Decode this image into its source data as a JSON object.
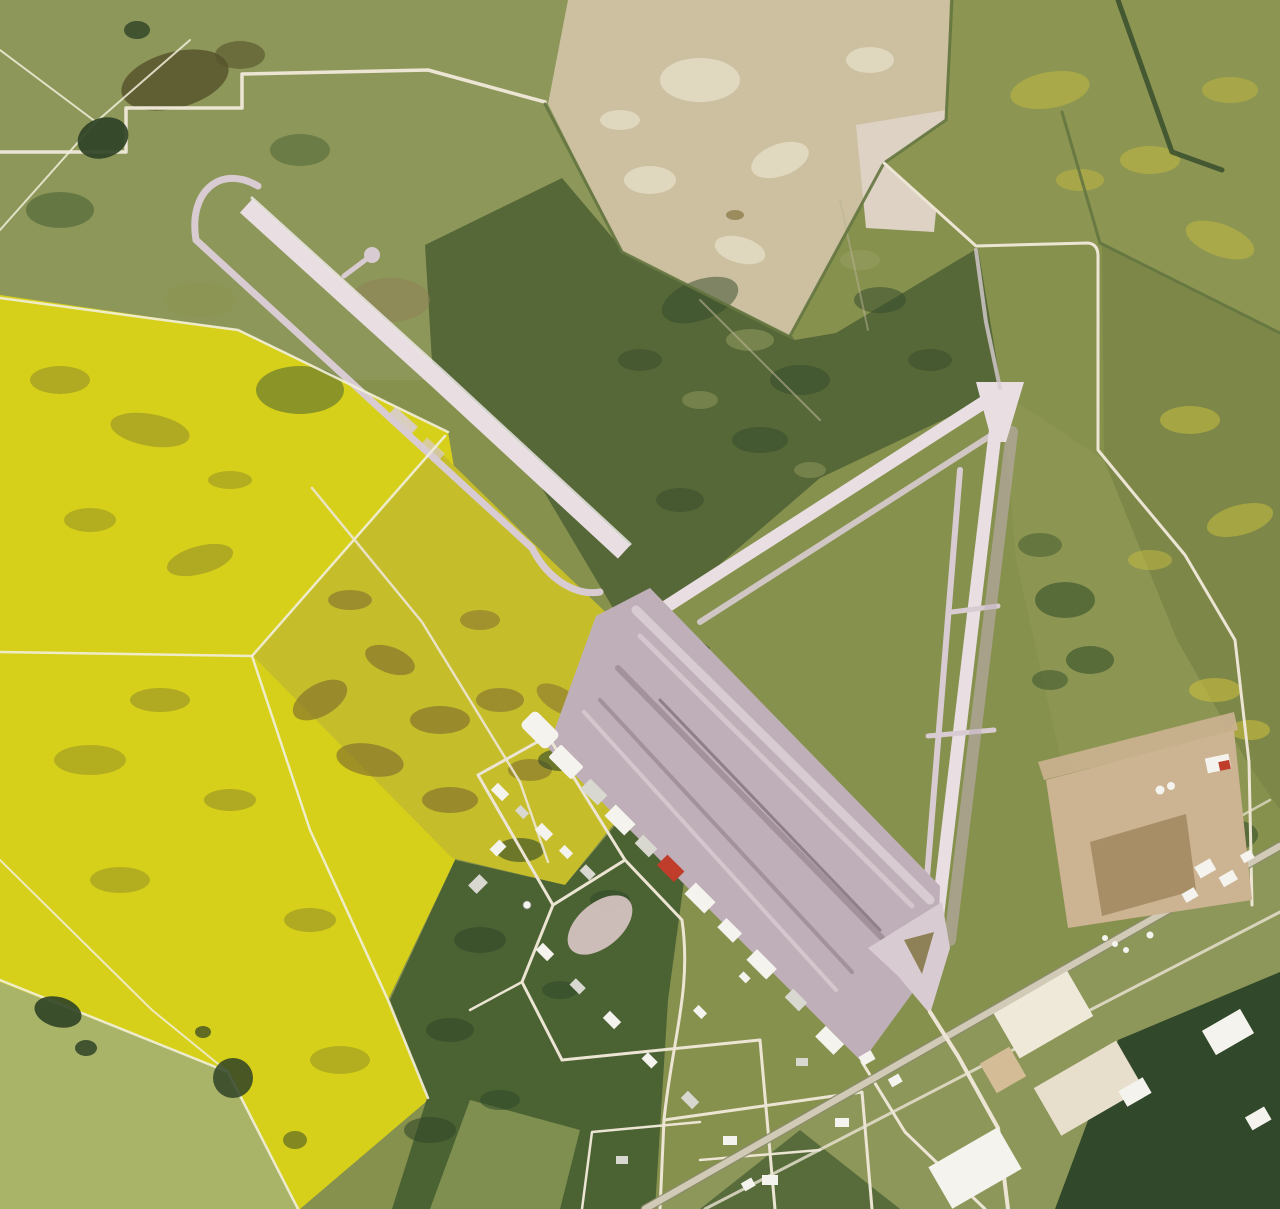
{
  "scene": {
    "description": "Aerial satellite photograph of an abandoned triangular airfield surrounded by farmland: a long NW-SE main runway with a loop taxiway, a runway triangle converging at north and south vertices, a worn apron with a hangar line and service-road grid, bright yellow canola fields to the west, tan fallow fields to the north, a dark shelterbelt forest strip, a gravel pad, and a diagonal highway with white industrial buildings in the southeast corner.",
    "features": [
      {
        "name": "main-runway",
        "label": "Main runway NW-SE"
      },
      {
        "name": "crosswind-runway-ne",
        "label": "Crosswind runway from north vertex to main runway"
      },
      {
        "name": "north-south-runway",
        "label": "North-south runway of triangle"
      },
      {
        "name": "loop-taxiway",
        "label": "Loop taxiway around northwest runway end"
      },
      {
        "name": "apron",
        "label": "Worn apron with parallel taxi lanes"
      },
      {
        "name": "hangar-row",
        "label": "Row of hangars along apron edge"
      },
      {
        "name": "red-roof-building",
        "label": "Small red-roofed building in hangar row"
      },
      {
        "name": "base-township",
        "label": "Service building grid southwest of apron"
      },
      {
        "name": "canola-fields",
        "label": "Bright yellow canola fields"
      },
      {
        "name": "tan-fields",
        "label": "Tan fallow fields to the north"
      },
      {
        "name": "forest-strip",
        "label": "Dark shelterbelt forest strip"
      },
      {
        "name": "gravel-pad",
        "label": "Large tan gravel pad east of south vertex"
      },
      {
        "name": "highway",
        "label": "Diagonal highway across southeast corner"
      },
      {
        "name": "industrial-buildings",
        "label": "White industrial warehouses along highway"
      },
      {
        "name": "ponds",
        "label": "Small dark ponds and tree clumps"
      }
    ]
  },
  "palette": {
    "base": "#87914e",
    "sage": "#8d975a",
    "palegrass": "#a9b468",
    "canola": "#d7d01a",
    "canola2": "#c6bd2a",
    "canolashadow": "#878427",
    "dirt": "#7c672f",
    "darkbrown": "#55512a",
    "forest1": "#32482a",
    "forest2": "#4b6233",
    "scrub": "#566838",
    "olive1": "#8d9552",
    "olive2": "#7d8748",
    "mottleyellow": "#c8bd3f",
    "tan": "#ccc0a0",
    "tanlight": "#e4dcc6",
    "tanpale": "#ddd2c4",
    "hedge": "#647540",
    "runway": "#e9dfe3",
    "runwaymid": "#d8ccd2",
    "apron": "#bfafb8",
    "apronstreak": "#a3919c",
    "apronlight": "#d4c6cc",
    "infield": "#8f8157",
    "road": "#ece5d4",
    "hwy": "#d0cab6",
    "hwycasing": "#8b8b6b",
    "tanpad": "#ccb392",
    "tanpaddark": "#a0875f",
    "bwhite": "#f4f3ee",
    "bgray": "#d9d8d0",
    "bcream": "#efe9da",
    "bcream2": "#e7dfcc",
    "red": "#c03d2c",
    "pond": "#2f4226",
    "path": "#b9b295",
    "fence": "#f2eedb"
  }
}
